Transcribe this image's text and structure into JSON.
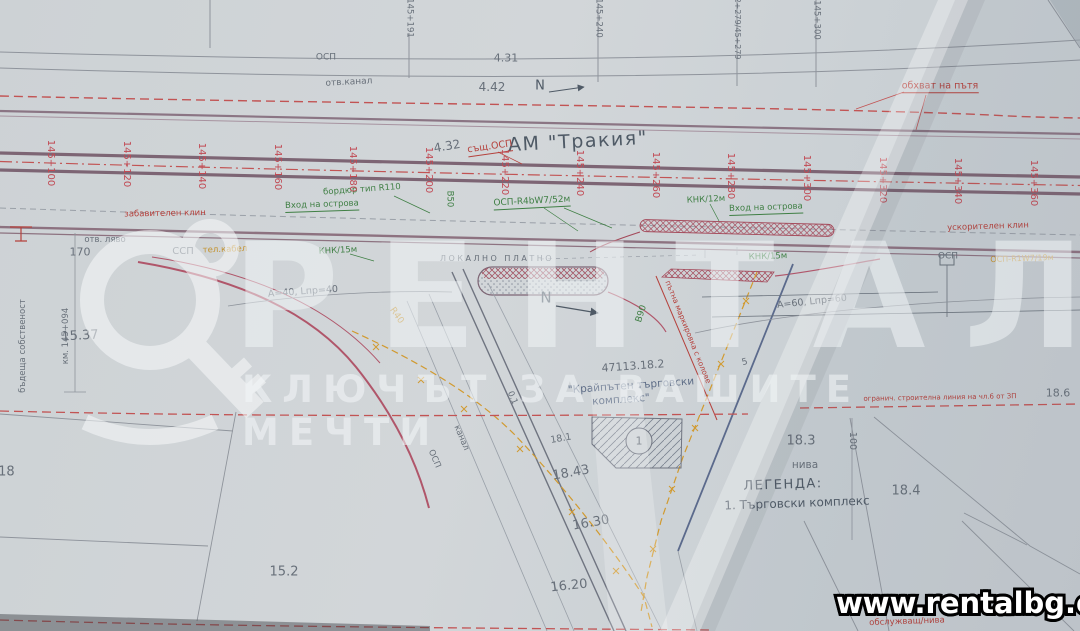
{
  "watermark": {
    "brand": "РЕНТАЛ",
    "tagline": "КЛЮЧЪТ ЗА ВАШИТЕ МЕЧТИ",
    "url": "www.rentalbg.com"
  },
  "plan": {
    "road_title": "АМ \"Тракия\"",
    "stations": [
      "145+100",
      "145+120",
      "145+140",
      "145+160",
      "145+180",
      "145+200",
      "145+220",
      "145+240",
      "145+260",
      "145+280",
      "145+300",
      "145+320",
      "145+340",
      "145+360"
    ],
    "legend": {
      "heading": "ЛЕГЕНДА:",
      "items": [
        "1. Търговски комплекс"
      ]
    },
    "colors": {
      "station_red": "#c14953",
      "line_green": "#3f7f44",
      "accent_orange": "#c3922e",
      "road_purple": "#7d6574",
      "dash_red": "#c25454"
    },
    "labels": [
      {
        "n": "osp-top",
        "t": "ОСП",
        "x": 326,
        "y": 58,
        "s": 9,
        "c": "c-gray"
      },
      {
        "n": "otv-kanal",
        "t": "отв.канал",
        "x": 349,
        "y": 83,
        "s": 9,
        "c": "c-gray",
        "r": -3
      },
      {
        "n": "dim-4-31",
        "t": "4.31",
        "x": 506,
        "y": 58,
        "s": 11,
        "c": "c-gray"
      },
      {
        "n": "dim-4-42",
        "t": "4.42",
        "x": 492,
        "y": 87,
        "s": 12,
        "c": "c-gray"
      },
      {
        "n": "north-arrow-top-letter",
        "t": "N",
        "x": 540,
        "y": 86,
        "s": 13,
        "c": "c-dark"
      },
      {
        "n": "obhvat-na-patya",
        "t": "обхват на пътя",
        "x": 940,
        "y": 87,
        "s": 9.5,
        "c": "c-red u"
      },
      {
        "n": "ref-145-191",
        "t": "145+191",
        "x": 409,
        "y": 18,
        "s": 8.5,
        "c": "c-gray",
        "r": 90
      },
      {
        "n": "ref-145-240",
        "t": "145+240",
        "x": 598,
        "y": 18,
        "s": 8.5,
        "c": "c-gray",
        "r": 90
      },
      {
        "n": "ref-62-279",
        "t": "62+279/45+279",
        "x": 737,
        "y": 26,
        "s": 8,
        "c": "c-gray",
        "r": 90
      },
      {
        "n": "ref-145-300",
        "t": "145+300",
        "x": 816,
        "y": 20,
        "s": 8.5,
        "c": "c-gray",
        "r": 90
      },
      {
        "n": "road-title",
        "t": "АМ \"Тракия\"",
        "x": 578,
        "y": 142,
        "s": 19,
        "c": "c-dark lsm",
        "r": -3
      },
      {
        "n": "dim-4-32",
        "t": "4.32",
        "x": 447,
        "y": 146,
        "s": 12,
        "c": "c-gray",
        "r": -10
      },
      {
        "n": "sasht-osp",
        "t": "същ.ОСП",
        "x": 490,
        "y": 148,
        "s": 9.5,
        "c": "c-red u",
        "r": -8
      },
      {
        "n": "bordyur-r110",
        "t": "бордюр тип R110",
        "x": 362,
        "y": 190,
        "s": 8.5,
        "c": "c-green",
        "r": -4
      },
      {
        "n": "vhod-ostrova-left",
        "t": "Вход на острова",
        "x": 322,
        "y": 206,
        "s": 8.5,
        "c": "c-green u",
        "r": -2
      },
      {
        "n": "v50",
        "t": "В50",
        "x": 449,
        "y": 199,
        "s": 8.5,
        "c": "c-green",
        "r": 90
      },
      {
        "n": "osp-r4bw7",
        "t": "ОСП-R4bW7/52м",
        "x": 532,
        "y": 203,
        "s": 9,
        "c": "c-green u",
        "r": -3
      },
      {
        "n": "knk-12m",
        "t": "КНК/12м",
        "x": 706,
        "y": 200,
        "s": 8.5,
        "c": "c-green",
        "r": -3
      },
      {
        "n": "vhod-ostrova-right",
        "t": "Вход на острова",
        "x": 766,
        "y": 209,
        "s": 8.5,
        "c": "c-green u",
        "r": -2
      },
      {
        "n": "zabavitelen-klin",
        "t": "забавителен клин",
        "x": 165,
        "y": 214,
        "s": 8.5,
        "c": "c-red",
        "r": -1
      },
      {
        "n": "uskoritelen-klin",
        "t": "ускорителен клин",
        "x": 988,
        "y": 227,
        "s": 8.5,
        "c": "c-red",
        "r": -2
      },
      {
        "n": "otv-lyavo",
        "t": "отв. ляво",
        "x": 105,
        "y": 240,
        "s": 8.5,
        "c": "c-gray"
      },
      {
        "n": "dim-170",
        "t": "170",
        "x": 80,
        "y": 252,
        "s": 11,
        "c": "c-gray"
      },
      {
        "n": "ssp-left",
        "t": "ССП",
        "x": 183,
        "y": 252,
        "s": 10,
        "c": "c-gray"
      },
      {
        "n": "tel-kabel",
        "t": "тел.кабел",
        "x": 225,
        "y": 250,
        "s": 8.5,
        "c": "c-orange",
        "r": -2
      },
      {
        "n": "knk-15m-left",
        "t": "КНК/15м",
        "x": 338,
        "y": 251,
        "s": 8.5,
        "c": "c-green",
        "r": -3
      },
      {
        "n": "lokalno-platno",
        "t": "ЛОКАЛНО ПЛАТНО",
        "x": 497,
        "y": 259,
        "s": 8,
        "c": "c-gray ls"
      },
      {
        "n": "knk-15m-right",
        "t": "КНК/15м",
        "x": 768,
        "y": 257,
        "s": 8.5,
        "c": "c-green",
        "r": -2
      },
      {
        "n": "osp-right",
        "t": "ОСП",
        "x": 948,
        "y": 257,
        "s": 9,
        "c": "c-gray"
      },
      {
        "n": "osp-r1w7",
        "t": "ОСП-R1W7/19м",
        "x": 1022,
        "y": 259,
        "s": 8,
        "c": "c-orange",
        "r": -2
      },
      {
        "n": "north-arrow-mid-letter",
        "t": "N",
        "x": 546,
        "y": 298,
        "s": 15,
        "c": "c-dark"
      },
      {
        "n": "dim-a40",
        "t": "А=40, Lпр=40",
        "x": 303,
        "y": 292,
        "s": 9.5,
        "c": "c-gray",
        "r": -4
      },
      {
        "n": "dim-a60",
        "t": "А=60, Lпр=60",
        "x": 812,
        "y": 302,
        "s": 9.5,
        "c": "c-gray",
        "r": -6
      },
      {
        "n": "r40",
        "t": "R40",
        "x": 396,
        "y": 316,
        "s": 9,
        "c": "c-orange",
        "r": 55
      },
      {
        "n": "v90",
        "t": "В90",
        "x": 642,
        "y": 314,
        "s": 9,
        "c": "c-green",
        "r": -72
      },
      {
        "n": "marking-note",
        "t": "пътна маркировка с колове",
        "x": 688,
        "y": 332,
        "s": 7.5,
        "c": "c-red",
        "r": 68
      },
      {
        "n": "tick-5",
        "t": "5",
        "x": 745,
        "y": 363,
        "s": 9,
        "c": "c-gray",
        "r": -15
      },
      {
        "n": "parcel-47113-18-2",
        "t": "47113.18.2",
        "x": 633,
        "y": 366,
        "s": 11,
        "c": "c-gray",
        "r": -4
      },
      {
        "n": "kompleks-line1",
        "t": "\"Крайпътен търговски",
        "x": 631,
        "y": 386,
        "s": 10.5,
        "c": "c-blue",
        "r": -4
      },
      {
        "n": "kompleks-line2",
        "t": "комплекс\"",
        "x": 621,
        "y": 400,
        "s": 10.5,
        "c": "c-blue",
        "r": -4
      },
      {
        "n": "building-number",
        "t": "1",
        "x": 639,
        "y": 441,
        "s": 11,
        "c": "c-gray"
      },
      {
        "n": "kanal-diag",
        "t": "канал",
        "x": 461,
        "y": 438,
        "s": 8.5,
        "c": "c-gray",
        "r": 67
      },
      {
        "n": "osp-diag",
        "t": "ОСП",
        "x": 434,
        "y": 459,
        "s": 8.5,
        "c": "c-gray",
        "r": 67
      },
      {
        "n": "dim-0-1",
        "t": "0.1",
        "x": 512,
        "y": 398,
        "s": 8.5,
        "c": "c-gray",
        "r": 67
      },
      {
        "n": "parcel-15-37",
        "t": "15.37",
        "x": 80,
        "y": 336,
        "s": 13,
        "c": "c-gray",
        "r": -3
      },
      {
        "n": "parcel-18-18",
        "t": "18.18",
        "x": -4,
        "y": 472,
        "s": 13,
        "c": "c-gray"
      },
      {
        "n": "parcel-15-2",
        "t": "15.2",
        "x": 284,
        "y": 572,
        "s": 13,
        "c": "c-gray"
      },
      {
        "n": "parcel-18-43",
        "t": "18.43",
        "x": 571,
        "y": 473,
        "s": 13,
        "c": "c-gray",
        "r": -10
      },
      {
        "n": "parcel-16-30",
        "t": "16.30",
        "x": 591,
        "y": 523,
        "s": 13,
        "c": "c-gray",
        "r": -10
      },
      {
        "n": "parcel-16-20",
        "t": "16.20",
        "x": 569,
        "y": 586,
        "s": 13,
        "c": "c-gray",
        "r": -6
      },
      {
        "n": "parcel-18-1",
        "t": "18.1",
        "x": 561,
        "y": 439,
        "s": 9.5,
        "c": "c-gray",
        "r": -10
      },
      {
        "n": "parcel-18-3",
        "t": "18.3",
        "x": 801,
        "y": 441,
        "s": 13,
        "c": "c-gray"
      },
      {
        "n": "niva-18-3",
        "t": "нива",
        "x": 805,
        "y": 465,
        "s": 10.5,
        "c": "c-gray"
      },
      {
        "n": "legend-heading",
        "t": "ЛЕГЕНДА:",
        "x": 783,
        "y": 485,
        "s": 13,
        "c": "c-dark lsm",
        "r": -2
      },
      {
        "n": "legend-item-1",
        "t": "1. Търговски комплекс",
        "x": 797,
        "y": 503,
        "s": 12,
        "c": "c-dark",
        "r": -2
      },
      {
        "n": "parcel-18-4",
        "t": "18.4",
        "x": 906,
        "y": 491,
        "s": 13,
        "c": "c-gray"
      },
      {
        "n": "parcel-18-6",
        "t": "18.6",
        "x": 1058,
        "y": 393,
        "s": 11,
        "c": "c-gray"
      },
      {
        "n": "dim-100",
        "t": "100",
        "x": 852,
        "y": 441,
        "s": 9.5,
        "c": "c-gray",
        "r": 90
      },
      {
        "n": "obsluzhvasht-niva",
        "t": "обслужващ/нива",
        "x": 907,
        "y": 622,
        "s": 8.5,
        "c": "c-red",
        "r": -2
      },
      {
        "n": "stroitelna-linia",
        "t": "огранич. строителна линия на чл.6 от ЗП",
        "x": 940,
        "y": 398,
        "s": 7,
        "c": "c-red",
        "r": -1
      },
      {
        "n": "km-145-094",
        "t": "км. 145+094",
        "x": 66,
        "y": 336,
        "s": 8.5,
        "c": "c-gray",
        "r": -90
      },
      {
        "n": "badeshta-sobstvenost",
        "t": "бъдеща собственост",
        "x": 23,
        "y": 346,
        "s": 8.5,
        "c": "c-gray",
        "r": -90
      }
    ]
  }
}
